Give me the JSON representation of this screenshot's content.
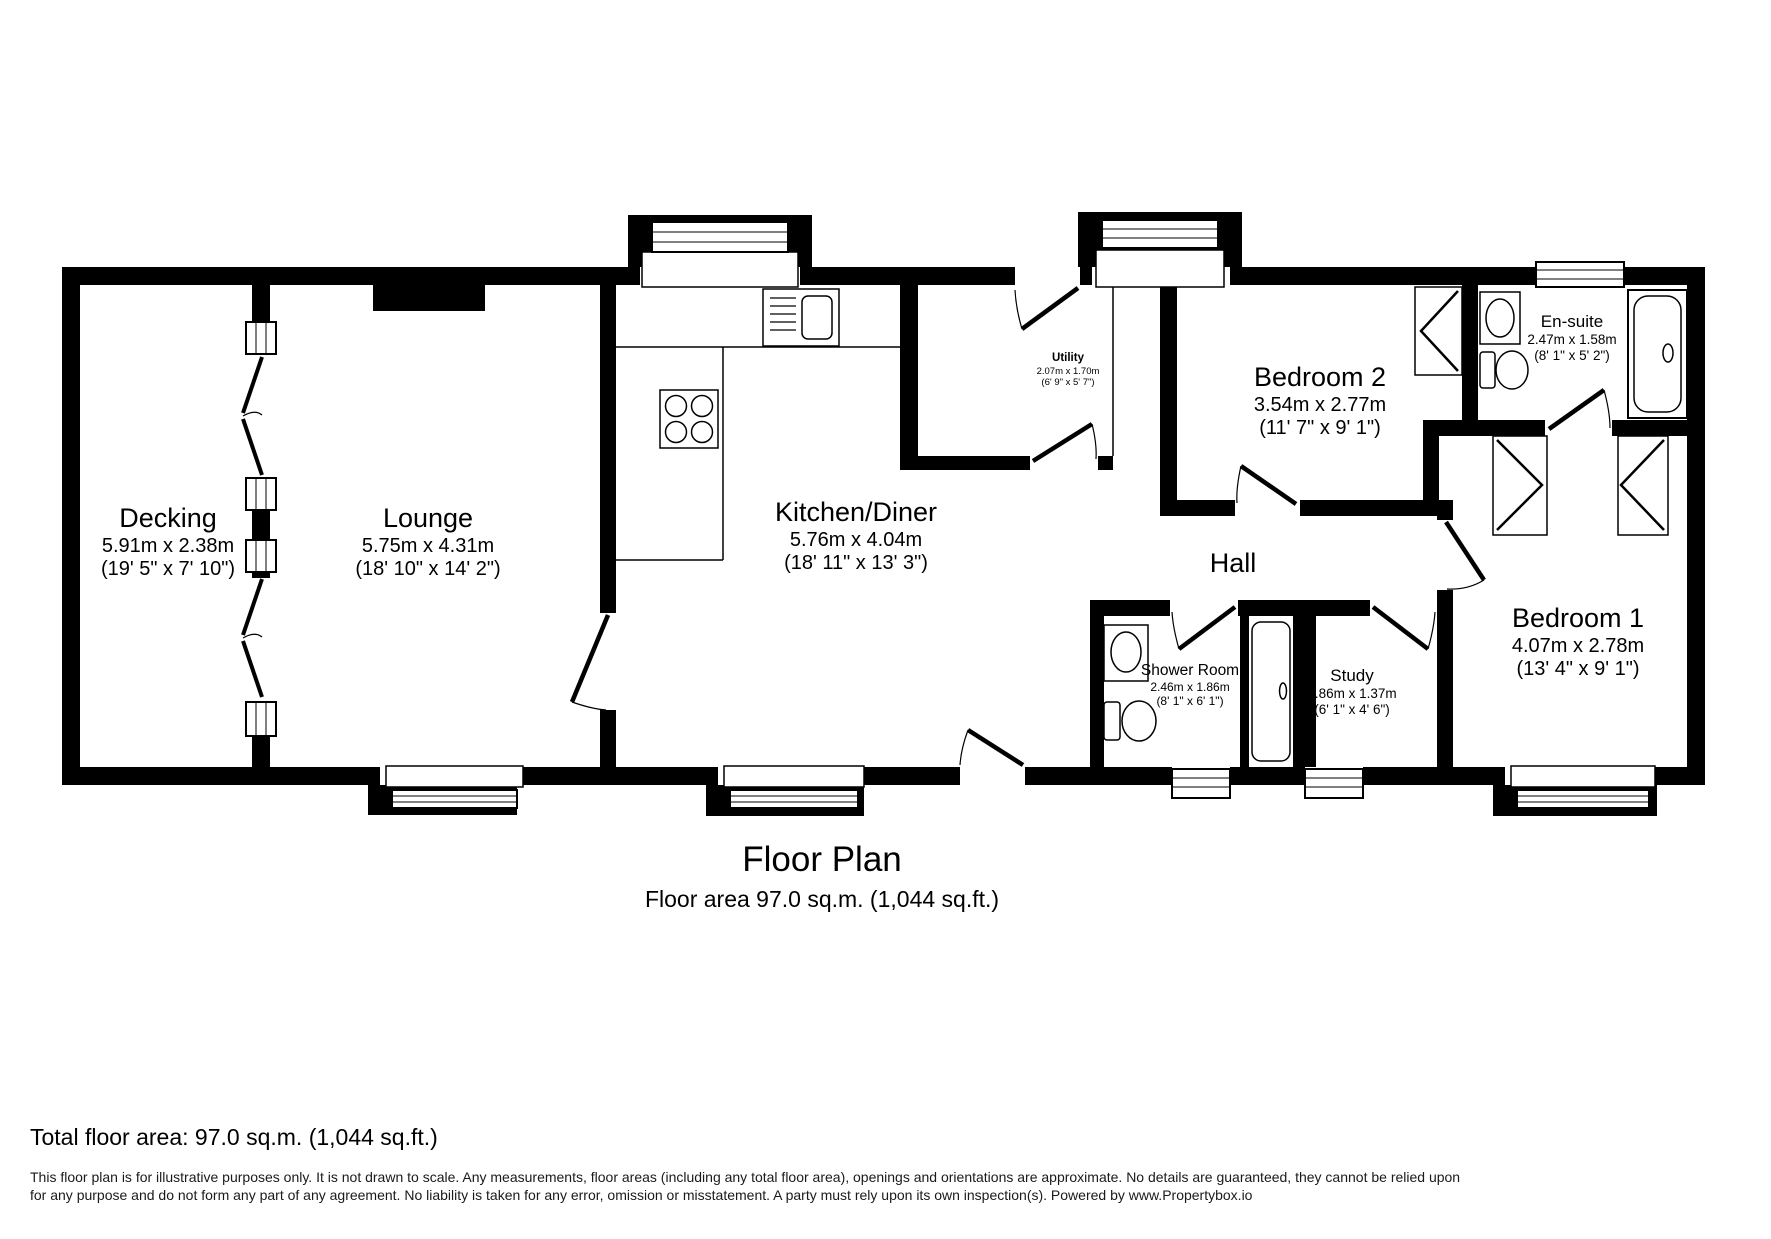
{
  "plan": {
    "title": "Floor Plan",
    "subtitle": "Floor area 97.0 sq.m. (1,044 sq.ft.)"
  },
  "rooms": [
    {
      "id": "decking",
      "name": "Decking",
      "metric": "5.91m x 2.38m",
      "imperial": "(19' 5\" x 7' 10\")"
    },
    {
      "id": "lounge",
      "name": "Lounge",
      "metric": "5.75m x 4.31m",
      "imperial": "(18' 10\" x 14' 2\")"
    },
    {
      "id": "kitchen",
      "name": "Kitchen/Diner",
      "metric": "5.76m x 4.04m",
      "imperial": "(18' 11\" x 13' 3\")"
    },
    {
      "id": "utility",
      "name": "Utility",
      "metric": "2.07m x 1.70m",
      "imperial": "(6' 9\" x 5' 7\")"
    },
    {
      "id": "bedroom2",
      "name": "Bedroom 2",
      "metric": "3.54m x 2.77m",
      "imperial": "(11' 7\" x 9' 1\")"
    },
    {
      "id": "ensuite",
      "name": "En-suite",
      "metric": "2.47m x 1.58m",
      "imperial": "(8' 1\" x 5' 2\")"
    },
    {
      "id": "hall",
      "name": "Hall",
      "metric": "",
      "imperial": ""
    },
    {
      "id": "shower",
      "name": "Shower Room",
      "metric": "2.46m x 1.86m",
      "imperial": "(8' 1\" x 6' 1\")"
    },
    {
      "id": "study",
      "name": "Study",
      "metric": "1.86m x 1.37m",
      "imperial": "(6' 1\" x 4' 6\")"
    },
    {
      "id": "bedroom1",
      "name": "Bedroom 1",
      "metric": "4.07m x 2.78m",
      "imperial": "(13' 4\" x 9' 1\")"
    }
  ],
  "footer": {
    "total": "Total floor area: 97.0 sq.m. (1,044 sq.ft.)",
    "disclaimer1": "This floor plan is for illustrative purposes only. It is not drawn to scale. Any measurements, floor areas (including any total floor area), openings and orientations are approximate. No details are guaranteed, they cannot be relied upon",
    "disclaimer2": "for any purpose and do not form any part of any agreement. No liability is taken for any error, omission or misstatement. A party must rely upon its own inspection(s). Powered by www.Propertybox.io"
  },
  "colors": {
    "wall": "#000000",
    "background": "#ffffff",
    "text": "#000000"
  }
}
